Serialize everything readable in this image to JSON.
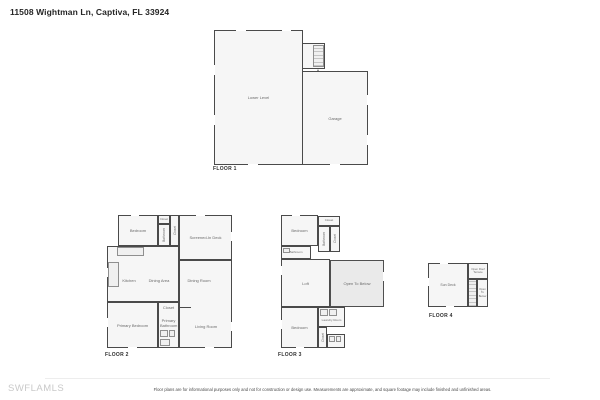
{
  "title": "11508 Wightman Ln, Captiva, FL 33924",
  "watermark": "SWFLAMLS",
  "disclaimer": "Floor plans are for informational purposes only and not for construction or design use. Measurements are approximate, and square footage may include finished and unfinished areas.",
  "floors": {
    "f1": {
      "label": "FLOOR 1",
      "rooms": {
        "lower_level": "Lower Level",
        "garage": "Garage",
        "entry": "Entry"
      }
    },
    "f2": {
      "label": "FLOOR 2",
      "rooms": {
        "bedroom": "Bedroom",
        "closet_top": "Closet",
        "bathroom": "Bathroom",
        "closet": "Closet",
        "screened_deck": "Screened-In Deck",
        "kitchen": "Kitchen",
        "dining_area": "Dining Area",
        "dining_room": "Dining Room",
        "primary_bedroom": "Primary Bedroom",
        "primary_bathroom": "Primary Bathroom",
        "closet_mid": "Closet",
        "living_room": "Living Room"
      }
    },
    "f3": {
      "label": "FLOOR 3",
      "rooms": {
        "closet_top": "Closet",
        "bedroom_top": "Bedroom",
        "bathroom_v": "Bathroom",
        "closet_v": "Closet",
        "bathroom": "Bathroom",
        "loft": "Loft",
        "open_to_below": "Open To Below",
        "laundry": "Laundry Room",
        "bedroom_bottom": "Bedroom",
        "closet_bottom": "Closet"
      }
    },
    "f4": {
      "label": "FLOOR 4",
      "rooms": {
        "sun_deck": "Sun Deck",
        "roof_terrace": "Open Roof Terrace",
        "open_to_below": "Open To Below"
      }
    }
  },
  "colors": {
    "wall": "#4a4a4a",
    "room_fill": "#f6f6f6",
    "open_below_fill": "#eaeaea",
    "watermark_color": "#c9c9c9"
  }
}
